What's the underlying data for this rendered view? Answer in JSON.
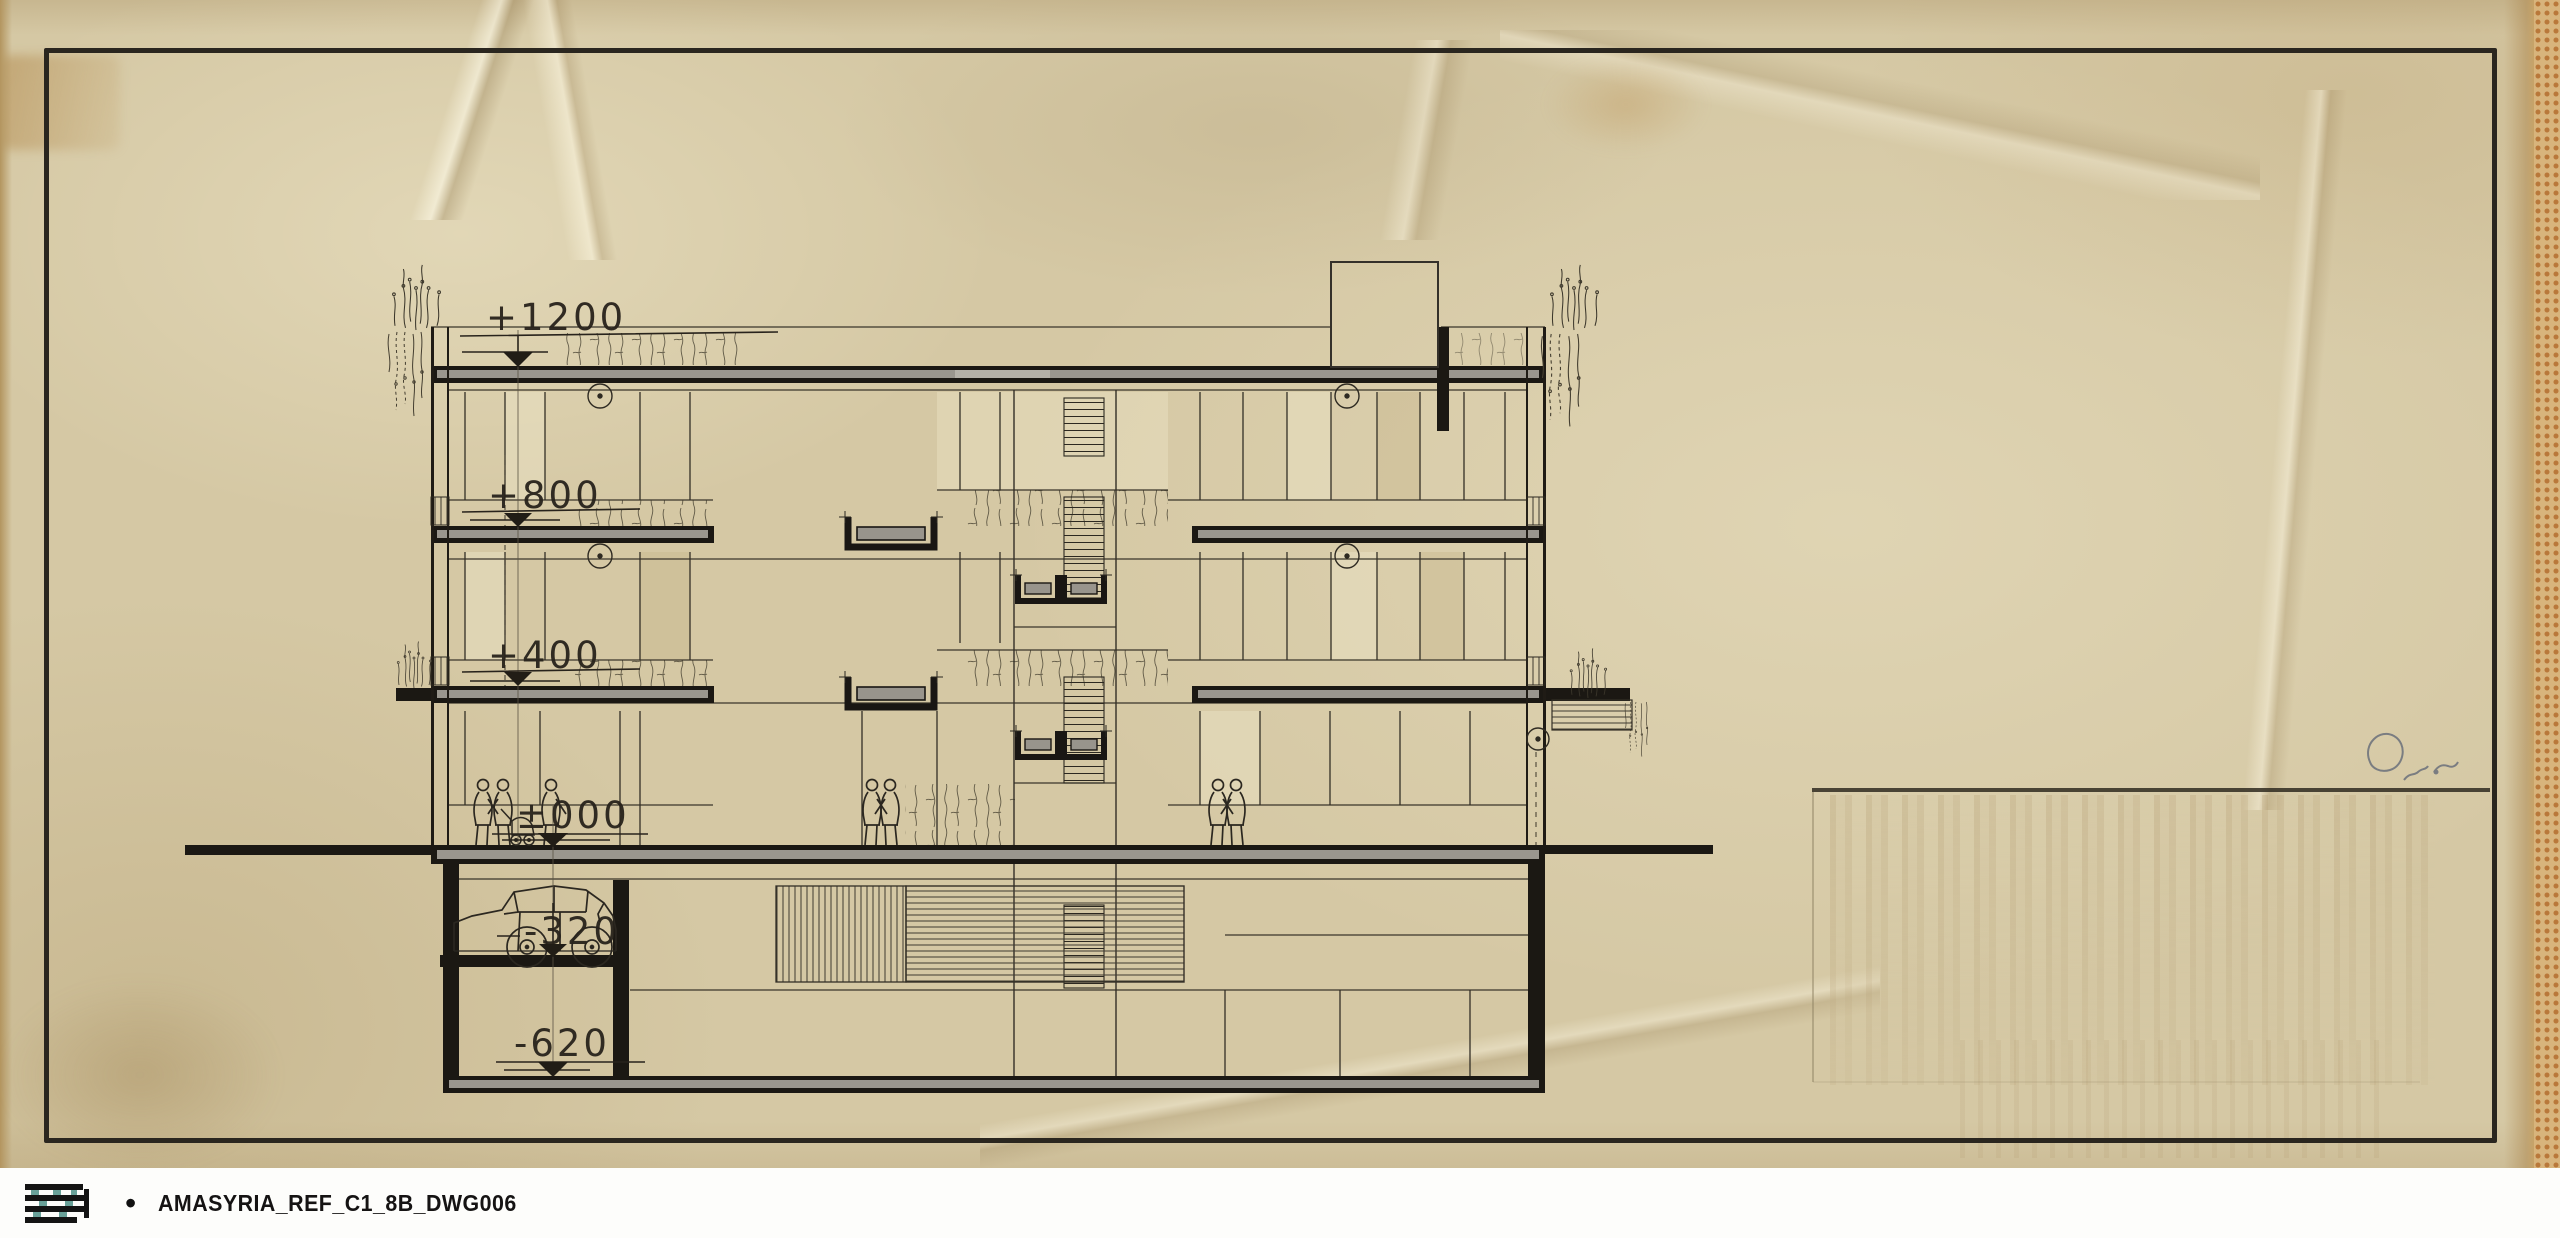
{
  "sheet": {
    "type": "scanned architectural tracing - building cross section",
    "footer": {
      "bullet": "•",
      "label": "AMASYRIA_REF_C1_8B_DWG006"
    },
    "icons": {
      "logo": "amasyria-logo-mark",
      "signature": "pencil-signature-mark"
    },
    "levels": [
      {
        "id": "roof",
        "label": "+1200"
      },
      {
        "id": "floor2",
        "label": "+800"
      },
      {
        "id": "floor1",
        "label": "+400"
      },
      {
        "id": "ground",
        "label": "±000"
      },
      {
        "id": "garage-upper",
        "label": "-320"
      },
      {
        "id": "garage-lower",
        "label": "-620"
      }
    ],
    "colors": {
      "paper": "#d5c8a4",
      "ink": "#26221b",
      "slab_core": "#98948c",
      "logo_accent": "#4f9187",
      "backing_dots": "#b9783a"
    }
  }
}
